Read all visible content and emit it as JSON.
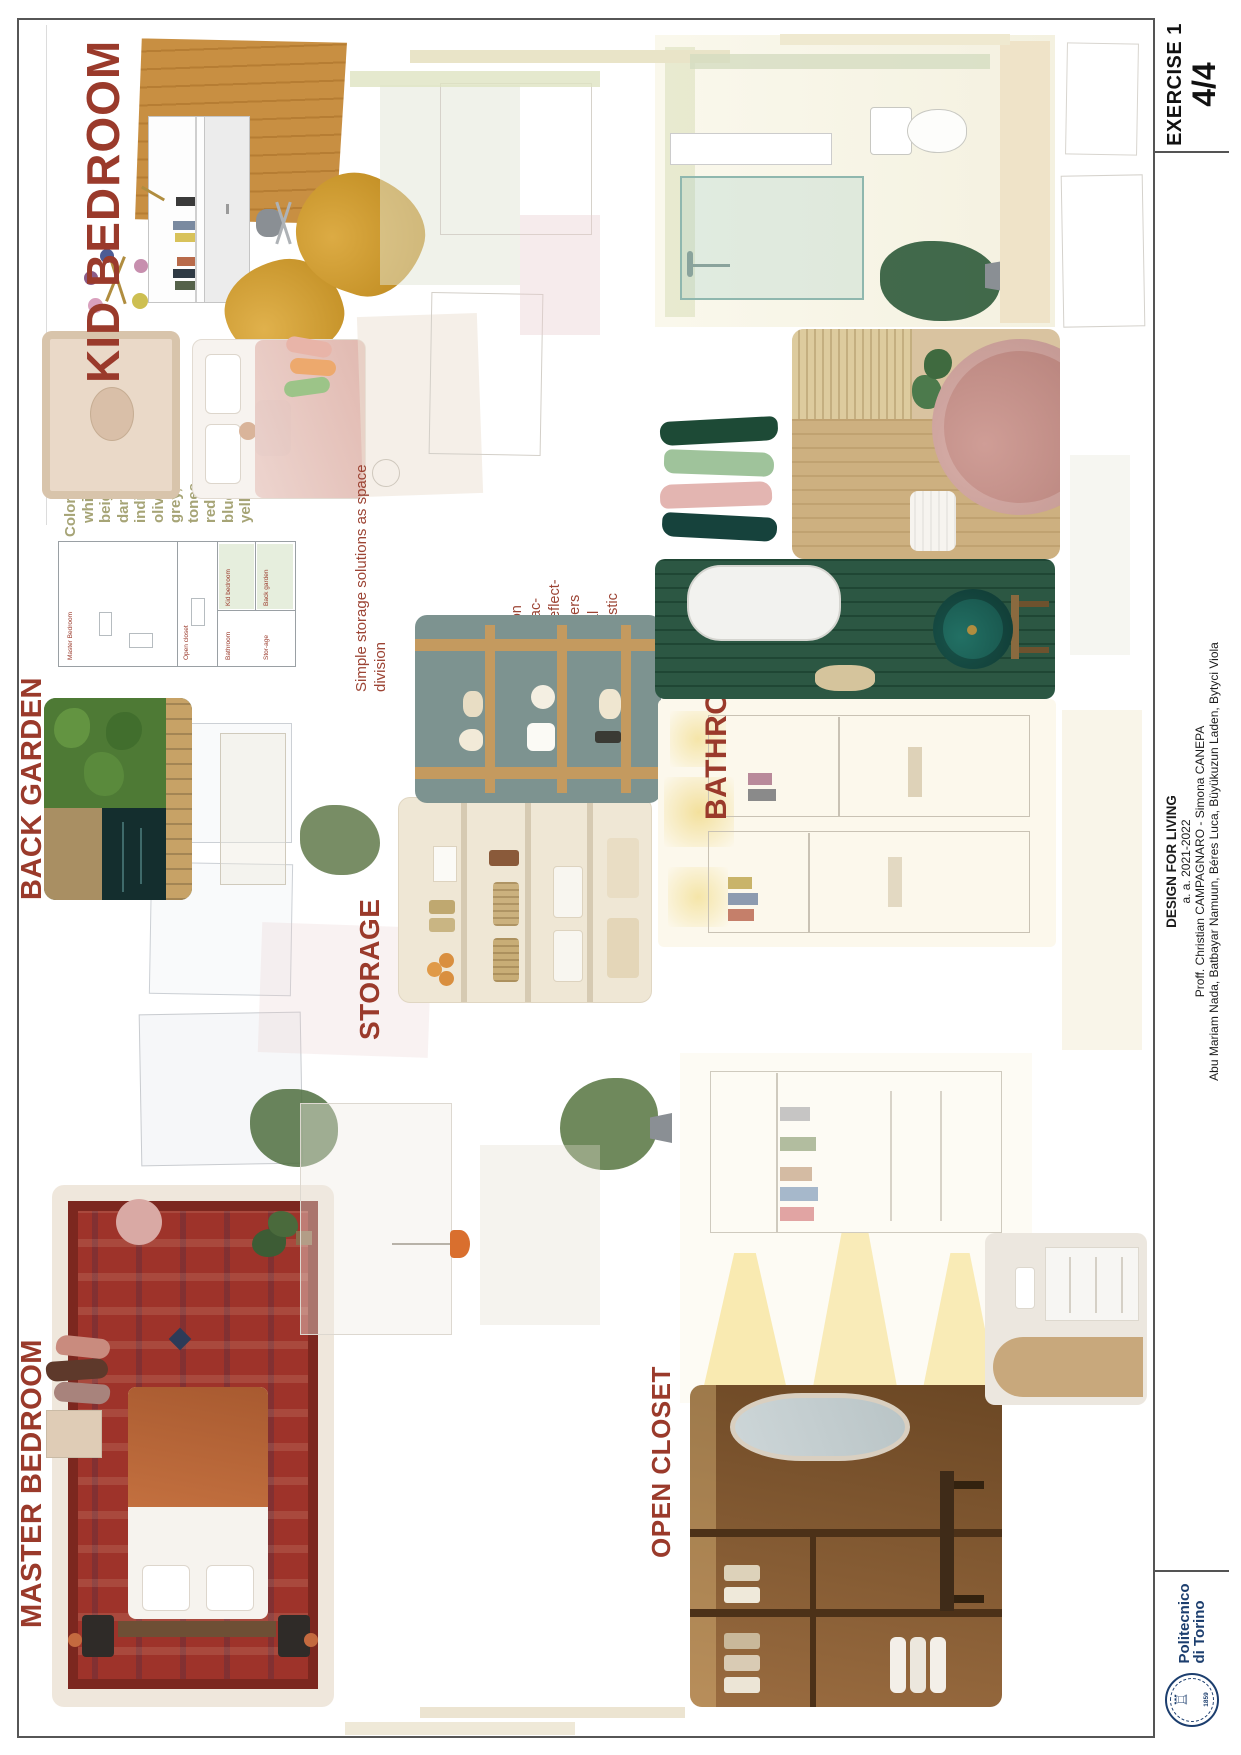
{
  "headings": {
    "kid_bedroom": "KID BEDROOM",
    "back_garden": "BACK GARDEN",
    "master_bedroom": "MASTER BEDROOM",
    "bathroom": "BATHROOM",
    "storage": "STORAGE",
    "open_closet": "OPEN CLOSET"
  },
  "colors_list": {
    "title": "Colors:",
    "items": [
      "white",
      "beige",
      "dark brown",
      "indian brown",
      "olive",
      "grey, aluminum",
      "tones",
      "red",
      "blue",
      "yellow"
    ]
  },
  "notes": {
    "storage": [
      "Simple storage solutions as space",
      "division"
    ],
    "emphasis": [
      "Emphasis on",
      "decorative ac-",
      "cessories reflect-",
      "ing the owners",
      "professional",
      "life in domestic",
      "terms"
    ]
  },
  "floor_plan": {
    "labels": {
      "master": "Master Bedroom",
      "open_closet": "Open closet",
      "storage": "Stor-age",
      "back_garden": "Back garden",
      "bathroom": "Bathroom",
      "kid": "Kid bedroom"
    }
  },
  "title_block": {
    "exercise": "EXERCISE 1",
    "sheet": "4/4",
    "course": "DESIGN FOR LIVING",
    "academic_year": "a. a. 2021-2022",
    "professors": "Proff. Christian CAMPAGNARO - Simona CANEPA",
    "students": "Abu Mariam Nada, Batbayar Namuun, Béres Luca, Büyükuzun Laden, Bytyci Viola",
    "university_line1": "Politecnico",
    "university_line2": "di Torino",
    "seal_year": "1859"
  },
  "palette": {
    "heading_red": "#9a3a2b",
    "olive_text": "#a6a476",
    "note_red": "#9c4434",
    "poli_blue": "#1c3e6e"
  }
}
